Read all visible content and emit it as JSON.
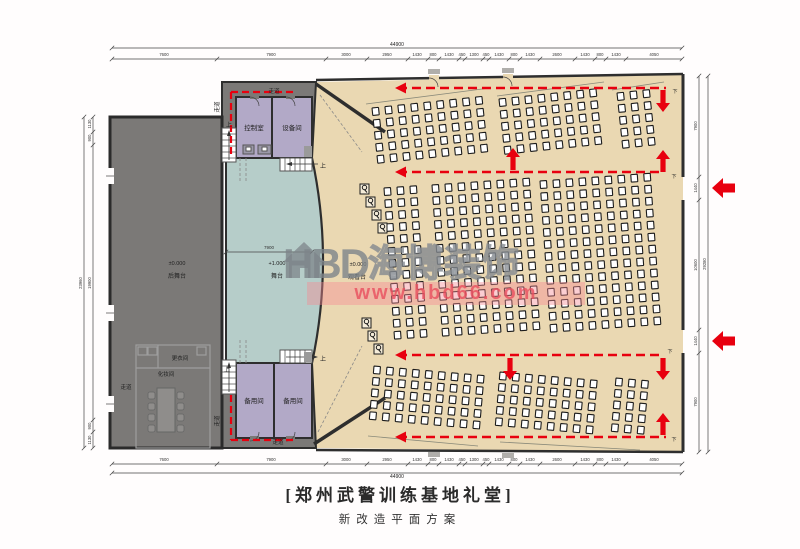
{
  "title": {
    "main": "[郑州武警训练基地礼堂]",
    "sub": "新改造平面方案"
  },
  "watermark": {
    "brand": "HBD",
    "brand_cn": "海博装饰",
    "url": "www.hbd66.com"
  },
  "colors": {
    "red": "#e8000f",
    "audience": "#ead8b2",
    "stage": "#b6cdc9",
    "backstage": "#7b7977",
    "rooms": "#b2a9c7"
  },
  "plan": {
    "texts": [
      {
        "n": "dim-top-total",
        "t": "44900",
        "x": 397,
        "y": 46,
        "s": 5
      },
      {
        "n": "dim-bottom-total",
        "t": "44900",
        "x": 397,
        "y": 478,
        "s": 5
      },
      {
        "n": "room-control-label",
        "t": "控制室",
        "x": 254,
        "y": 130,
        "s": 6.5
      },
      {
        "n": "room-equipment-label",
        "t": "设备间",
        "x": 292,
        "y": 130,
        "s": 6.5
      },
      {
        "n": "room-spare1-label",
        "t": "备用间",
        "x": 254,
        "y": 403,
        "s": 6.5
      },
      {
        "n": "room-spare2-label",
        "t": "备用间",
        "x": 293,
        "y": 403,
        "s": 6.5
      },
      {
        "n": "room-changing-label",
        "t": "更衣间",
        "x": 180,
        "y": 360,
        "s": 5.5
      },
      {
        "n": "room-makeup-label",
        "t": "化妆间",
        "x": 166,
        "y": 376,
        "s": 5.5
      },
      {
        "n": "corridor-backstage-label",
        "t": "走道",
        "x": 126,
        "y": 389,
        "s": 5.5
      },
      {
        "n": "corridor-top-label",
        "t": "走道",
        "x": 274,
        "y": 93,
        "s": 5.5
      },
      {
        "n": "corridor-left-top-label",
        "t": "走道",
        "x": 219,
        "y": 107,
        "s": 5.5,
        "r": -90
      },
      {
        "n": "corridor-left-bottom-label",
        "t": "走道",
        "x": 219,
        "y": 421,
        "s": 5.5,
        "r": -90
      },
      {
        "n": "corridor-bottom-label",
        "t": "走道",
        "x": 278,
        "y": 444,
        "s": 5.5
      },
      {
        "n": "level-backstage-value",
        "t": "±0.000",
        "x": 177,
        "y": 265,
        "s": 5.5
      },
      {
        "n": "level-backstage-label",
        "t": "后舞台",
        "x": 177,
        "y": 278,
        "s": 6
      },
      {
        "n": "level-stage-value",
        "t": "+1.000",
        "x": 277,
        "y": 265,
        "s": 5.5
      },
      {
        "n": "level-stage-label",
        "t": "舞台",
        "x": 277,
        "y": 278,
        "s": 6
      },
      {
        "n": "level-audience-value",
        "t": "±0.000",
        "x": 358,
        "y": 266,
        "s": 5.5
      },
      {
        "n": "level-audience-label",
        "t": "观看台",
        "x": 357,
        "y": 279,
        "s": 6
      },
      {
        "n": "stair-up-1",
        "t": "上",
        "x": 229,
        "y": 127,
        "s": 6
      },
      {
        "n": "stair-up-2",
        "t": "上",
        "x": 323,
        "y": 168,
        "s": 6
      },
      {
        "n": "stair-up-3",
        "t": "上",
        "x": 227,
        "y": 372,
        "s": 6
      },
      {
        "n": "stair-up-4",
        "t": "上",
        "x": 323,
        "y": 361,
        "s": 6
      },
      {
        "n": "exit-down-1",
        "t": "下",
        "x": 675,
        "y": 93,
        "s": 5
      },
      {
        "n": "exit-down-2",
        "t": "下",
        "x": 674,
        "y": 178,
        "s": 5
      },
      {
        "n": "exit-down-3",
        "t": "下",
        "x": 670,
        "y": 353,
        "s": 5
      },
      {
        "n": "exit-down-4",
        "t": "下",
        "x": 674,
        "y": 441,
        "s": 5
      }
    ],
    "dims_h": [
      {
        "y": 48,
        "x1": 112,
        "x2": 682,
        "ly": 0,
        "labels": []
      },
      {
        "y": 59,
        "x1": 112,
        "x2": 682,
        "ly": 56,
        "ticks": [
          112,
          217,
          326,
          367,
          408,
          428,
          439,
          459,
          465,
          483,
          489,
          509,
          520,
          540,
          575,
          595,
          606,
          626,
          682
        ],
        "labels": [
          [
            "7600",
            164
          ],
          [
            "7900",
            271
          ],
          [
            "3000",
            346
          ],
          [
            "2950",
            387
          ],
          [
            "1430",
            417
          ],
          [
            "800",
            433
          ],
          [
            "1430",
            449
          ],
          [
            "450",
            462
          ],
          [
            "1300",
            474
          ],
          [
            "450",
            486
          ],
          [
            "1430",
            499
          ],
          [
            "800",
            514
          ],
          [
            "1430",
            530
          ],
          [
            "2600",
            557
          ],
          [
            "1430",
            585
          ],
          [
            "800",
            600
          ],
          [
            "1430",
            616
          ],
          [
            "4050",
            654
          ]
        ]
      },
      {
        "y": 464,
        "x1": 112,
        "x2": 682,
        "ly": 461,
        "ticks": [
          112,
          217,
          326,
          367,
          408,
          428,
          439,
          459,
          465,
          483,
          489,
          509,
          520,
          540,
          575,
          595,
          606,
          626,
          682
        ],
        "labels": [
          [
            "7600",
            164
          ],
          [
            "7900",
            271
          ],
          [
            "3000",
            346
          ],
          [
            "2950",
            387
          ],
          [
            "1430",
            417
          ],
          [
            "800",
            433
          ],
          [
            "1430",
            449
          ],
          [
            "450",
            462
          ],
          [
            "1300",
            474
          ],
          [
            "450",
            486
          ],
          [
            "1430",
            499
          ],
          [
            "800",
            514
          ],
          [
            "1430",
            530
          ],
          [
            "2600",
            557
          ],
          [
            "1430",
            585
          ],
          [
            "800",
            600
          ],
          [
            "1430",
            616
          ],
          [
            "4050",
            654
          ]
        ]
      },
      {
        "y": 473,
        "x1": 112,
        "x2": 682,
        "ly": 0,
        "labels": []
      },
      {
        "y": 252,
        "x1": 226,
        "x2": 312,
        "ly": 249,
        "fs": 4.5,
        "ticks": [
          226,
          312
        ],
        "labels": [
          [
            "7900",
            269
          ]
        ]
      }
    ],
    "dims_v": [
      {
        "x": 93,
        "y1": 117,
        "y2": 448,
        "ticks": [
          117,
          132,
          145,
          420,
          432,
          448
        ],
        "labels": [
          [
            "1130",
            124
          ],
          [
            "900",
            138
          ],
          [
            "19900",
            283
          ],
          [
            "900",
            426
          ],
          [
            "1130",
            440
          ]
        ]
      },
      {
        "x": 84,
        "y1": 117,
        "y2": 448,
        "ticks": [
          117,
          448
        ],
        "labels": [
          [
            "23960",
            283
          ]
        ]
      },
      {
        "x": 699,
        "y1": 76,
        "y2": 452,
        "ticks": [
          76,
          177,
          200,
          330,
          353,
          452
        ],
        "labels": [
          [
            "7900",
            126
          ],
          [
            "1440",
            188
          ],
          [
            "10600",
            265
          ],
          [
            "1440",
            341
          ],
          [
            "7900",
            402
          ]
        ]
      },
      {
        "x": 708,
        "y1": 76,
        "y2": 452,
        "ticks": [
          76,
          452
        ],
        "labels": [
          [
            "29280",
            264
          ]
        ]
      }
    ],
    "seat_blocks": [
      {
        "x": 372,
        "y": 108,
        "cols": 9,
        "rows": 5,
        "cp": 13,
        "rp": 12,
        "rot": -6
      },
      {
        "x": 499,
        "y": 99,
        "cols": 8,
        "rows": 5,
        "cp": 13,
        "rp": 12,
        "rot": -6
      },
      {
        "x": 617,
        "y": 93,
        "cols": 3,
        "rows": 5,
        "cp": 13,
        "rp": 12,
        "rot": -6
      },
      {
        "x": 384,
        "y": 188,
        "cols": 3,
        "rows": 13,
        "cp": 13,
        "rp": 12,
        "rot": -4
      },
      {
        "x": 432,
        "y": 185,
        "cols": 8,
        "rows": 13,
        "cp": 13,
        "rp": 12,
        "rot": -4
      },
      {
        "x": 540,
        "y": 181,
        "cols": 9,
        "rows": 13,
        "cp": 13,
        "rp": 12,
        "rot": -4
      },
      {
        "x": 374,
        "y": 366,
        "cols": 9,
        "rows": 5,
        "cp": 13,
        "rp": 11.5,
        "rot": 5
      },
      {
        "x": 500,
        "y": 372,
        "cols": 8,
        "rows": 5,
        "cp": 13,
        "rp": 11.5,
        "rot": 5
      },
      {
        "x": 616,
        "y": 378,
        "cols": 3,
        "rows": 5,
        "cp": 13,
        "rp": 11.5,
        "rot": 5
      }
    ],
    "special_seats": [
      {
        "x": 360,
        "y": 184
      },
      {
        "x": 366,
        "y": 197
      },
      {
        "x": 372,
        "y": 210
      },
      {
        "x": 378,
        "y": 223
      },
      {
        "x": 362,
        "y": 318
      },
      {
        "x": 368,
        "y": 331
      },
      {
        "x": 374,
        "y": 344
      }
    ],
    "routes": [
      {
        "x1": 398,
        "y1": 88,
        "x2": 666,
        "y2": 88,
        "head": true
      },
      {
        "x1": 398,
        "y1": 172,
        "x2": 660,
        "y2": 172,
        "head": true
      },
      {
        "x1": 398,
        "y1": 355,
        "x2": 660,
        "y2": 355,
        "head": true
      },
      {
        "x1": 398,
        "y1": 437,
        "x2": 666,
        "y2": 437,
        "head": true
      },
      {
        "x1": 231,
        "y1": 92,
        "x2": 296,
        "y2": 92,
        "small": true
      },
      {
        "x1": 231,
        "y1": 92,
        "x2": 231,
        "y2": 156,
        "small": true
      },
      {
        "x1": 231,
        "y1": 395,
        "x2": 231,
        "y2": 440,
        "small": true
      },
      {
        "x1": 231,
        "y1": 440,
        "x2": 296,
        "y2": 440,
        "small": true
      }
    ],
    "arrows": [
      {
        "x": 663,
        "y": 112,
        "dir": "down"
      },
      {
        "x": 513,
        "y": 148,
        "dir": "up"
      },
      {
        "x": 663,
        "y": 150,
        "dir": "up"
      },
      {
        "x": 510,
        "y": 380,
        "dir": "down"
      },
      {
        "x": 663,
        "y": 380,
        "dir": "down"
      },
      {
        "x": 663,
        "y": 413,
        "dir": "up"
      },
      {
        "x": 712,
        "y": 188,
        "dir": "bigleft"
      },
      {
        "x": 712,
        "y": 341,
        "dir": "bigleft"
      }
    ]
  }
}
